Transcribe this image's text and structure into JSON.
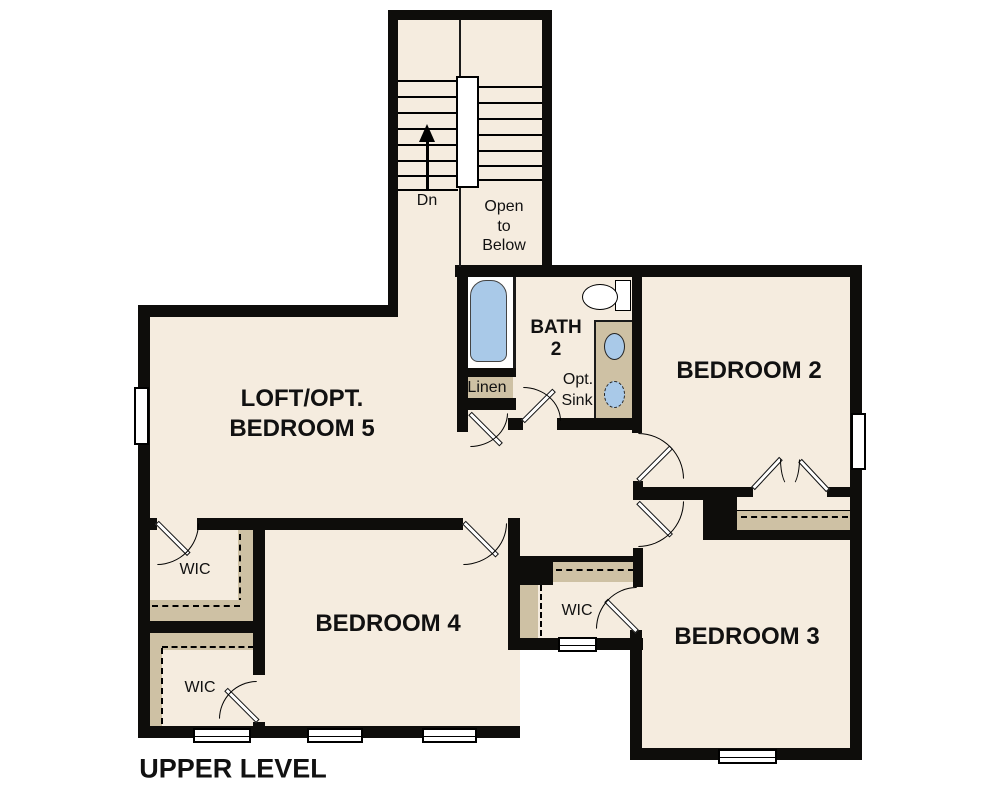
{
  "title": "UPPER LEVEL",
  "colors": {
    "floor": "#f5ecdf",
    "wall": "#0e0d0b",
    "shelf_tan": "#cec1a4",
    "fixture_blue": "#a9c9e8",
    "background": "#ffffff"
  },
  "rooms": {
    "loft": {
      "line1": "LOFT/OPT.",
      "line2": "BEDROOM 5"
    },
    "bedroom2": {
      "label": "BEDROOM 2"
    },
    "bedroom3": {
      "label": "BEDROOM 3"
    },
    "bedroom4": {
      "label": "BEDROOM 4"
    },
    "bath": {
      "line1": "BATH",
      "line2": "2"
    },
    "optSink": {
      "line1": "Opt.",
      "line2": "Sink"
    },
    "linen": {
      "label": "Linen"
    },
    "wicTopLeft": {
      "label": "WIC"
    },
    "wicBottomLeft": {
      "label": "WIC"
    },
    "wicMiddle": {
      "label": "WIC"
    },
    "stairs": {
      "down": "Dn",
      "open1": "Open",
      "open2": "to",
      "open3": "Below"
    }
  }
}
